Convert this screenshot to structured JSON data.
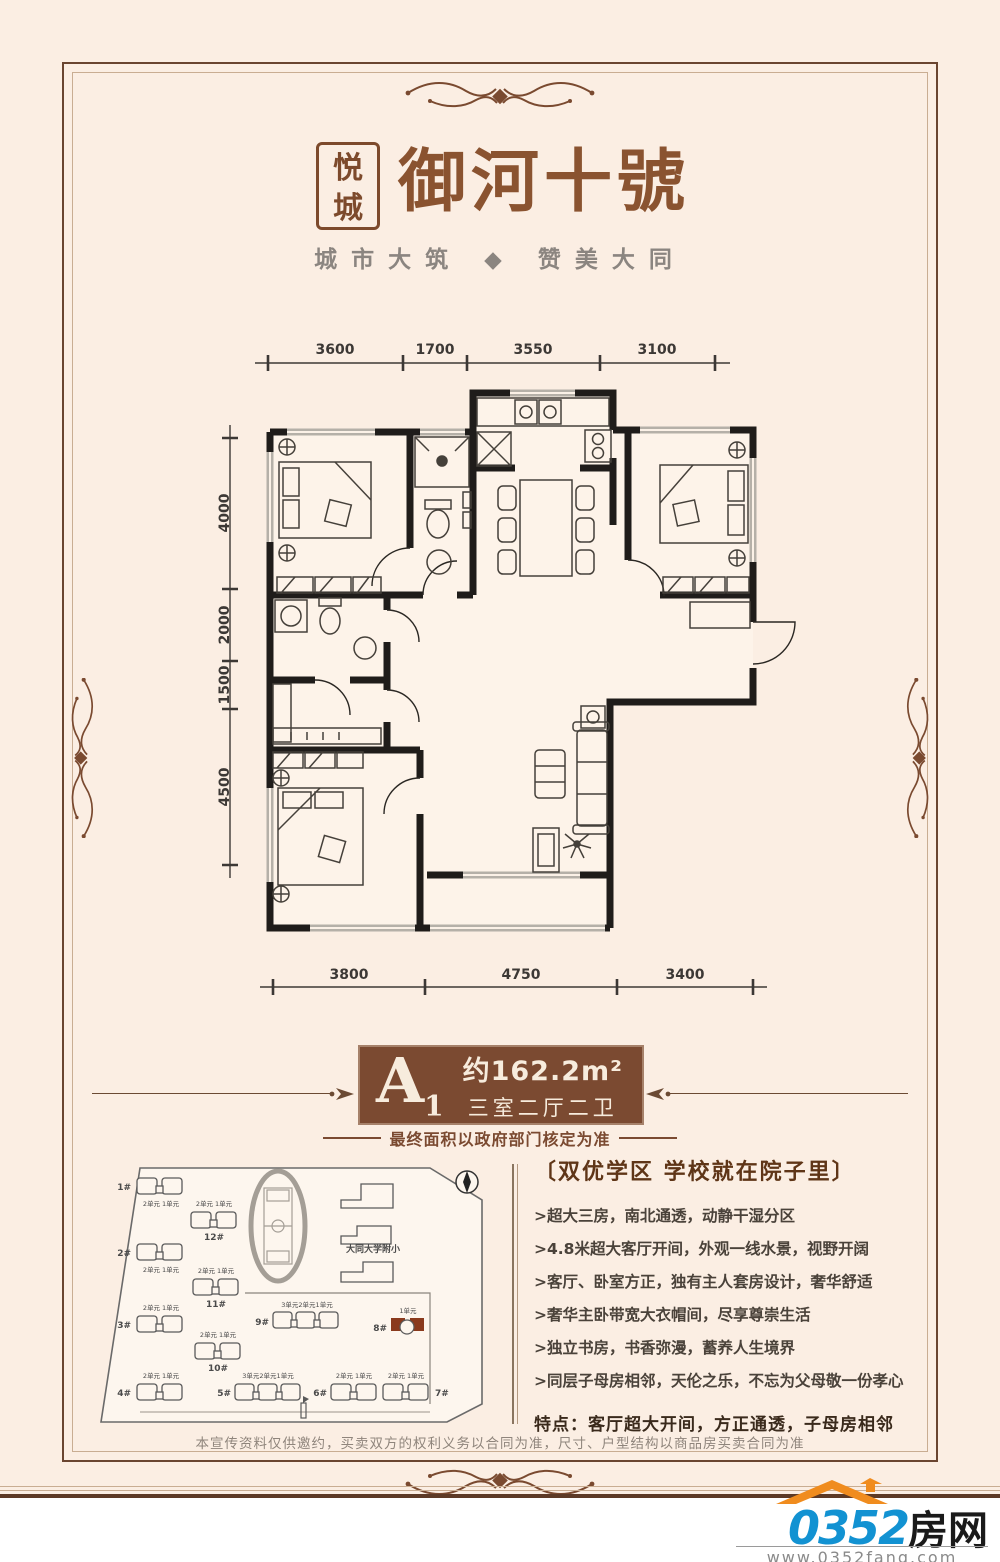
{
  "logo": {
    "seal_line1": "悦",
    "seal_line2": "城",
    "title": "御河十號",
    "subtitle": "城市大筑 ◆ 赞美大同"
  },
  "floorplan": {
    "dims_top": [
      "3600",
      "1700",
      "3550",
      "3100"
    ],
    "dims_left": [
      "4000",
      "2000",
      "1500",
      "4500"
    ],
    "dims_bottom": [
      "3800",
      "4750",
      "3400"
    ]
  },
  "unit_badge": {
    "unit": "A",
    "unit_index": "1",
    "area": "约162.2m²",
    "rooms": "三室二厅二卫",
    "note": "最终面积以政府部门核定为准"
  },
  "features": {
    "header": "〔双优学区 学校就在院子里〕",
    "bullets": [
      ">超大三房，南北通透，动静干湿分区",
      ">4.8米超大客厅开间，外观一线水景，视野开阔",
      ">客厅、卧室方正，独有主人套房设计，奢华舒适",
      ">奢华主卧带宽大衣帽间，尽享尊崇生活",
      ">独立书房，书香弥漫，蓄养人生境界",
      ">同层子母房相邻，天伦之乐，不忘为父母敬一份孝心"
    ],
    "highlight": "特点：客厅超大开间，方正通透，子母房相邻"
  },
  "sitemap": {
    "school_label": "大同大学附小",
    "buildings": [
      {
        "label": "1#",
        "units": "2单元 1单元"
      },
      {
        "label": "2#",
        "units": "2单元 1单元"
      },
      {
        "label": "3#",
        "units": "2单元 1单元"
      },
      {
        "label": "4#",
        "units": "2单元 1单元"
      },
      {
        "label": "5#",
        "units": "3单元2单元1单元"
      },
      {
        "label": "6#",
        "units": "2单元 1单元"
      },
      {
        "label": "7#",
        "units": "2单元 1单元"
      },
      {
        "label": "8#",
        "units": "1单元"
      },
      {
        "label": "9#",
        "units": "3单元2单元1单元"
      },
      {
        "label": "10#",
        "units": "2单元 1单元"
      },
      {
        "label": "11#",
        "units": "2单元 1单元"
      },
      {
        "label": "12#",
        "units": "2单元 1单元"
      }
    ]
  },
  "footer": {
    "disclaimer": "本宣传资料仅供邀约，买卖双方的权利义务以合同为准，尺寸、户型结构以商品房买卖合同为准"
  },
  "brand": {
    "number": "0352",
    "name": "房网",
    "url": "www.0352fang.com"
  }
}
